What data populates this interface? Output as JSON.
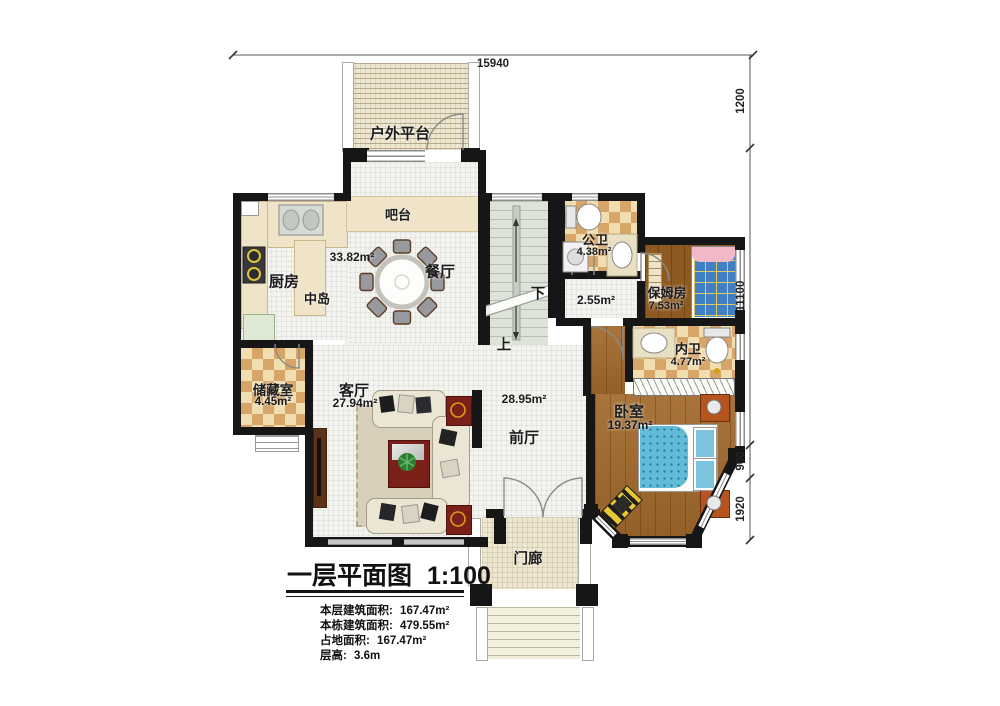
{
  "title_block": {
    "title": "一层平面图",
    "scale": "1:100",
    "stats": [
      {
        "label": "本层建筑面积:",
        "value": "167.47m²"
      },
      {
        "label": "本栋建筑面积:",
        "value": "479.55m²"
      },
      {
        "label": "占地面积:",
        "value": "167.47m²"
      },
      {
        "label": "层高:",
        "value": "3.6m"
      }
    ]
  },
  "dimensions": {
    "top": "15940",
    "right": [
      "1200",
      "11100",
      "900",
      "1920"
    ]
  },
  "stairs": {
    "up": "上",
    "down": "下"
  },
  "rooms": {
    "outdoor_platform": {
      "label": "户外平台"
    },
    "bar": {
      "label": "吧台"
    },
    "kitchen": {
      "label": "厨房"
    },
    "island": {
      "label": "中岛"
    },
    "dining": {
      "label": "餐厅",
      "area": "33.82m²"
    },
    "storage": {
      "label": "储藏室",
      "area": "4.45m²"
    },
    "living": {
      "label": "客厅",
      "area": "27.94m²"
    },
    "foyer": {
      "label": "前厅",
      "area": "28.95m²"
    },
    "hallway": {
      "area": "2.55m²"
    },
    "public_bath": {
      "label": "公卫",
      "area": "4.38m²"
    },
    "nanny_room": {
      "label": "保姆房",
      "area": "7.53m²"
    },
    "inner_bath": {
      "label": "内卫",
      "area": "4.77m²"
    },
    "bedroom": {
      "label": "卧室",
      "area": "19.37m²"
    },
    "porch": {
      "label": "门廊"
    }
  },
  "colors": {
    "wall": "#161616",
    "tile_floor": "#f3f3f0",
    "wood_floor": "#a26a2c",
    "checker_tan": "#d6a567",
    "stair_floor": "#dde3d8",
    "accent_red": "#7a2018",
    "bed_blue": "#62bcd8"
  }
}
